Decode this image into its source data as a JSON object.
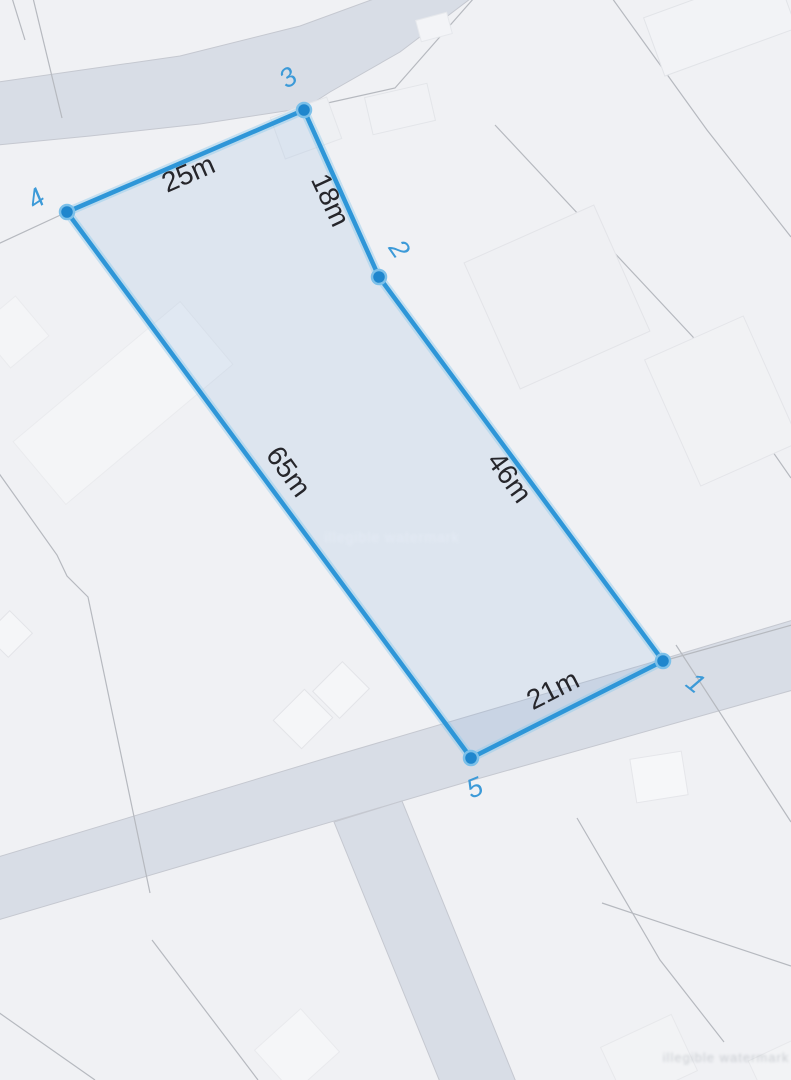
{
  "map": {
    "view": "parcel-measurement-overlay",
    "colors": {
      "background": "#f0f1f4",
      "road": "#d8dde6",
      "parcel_line": "#b6b9bf",
      "polygon_stroke": "#2e96d8",
      "polygon_fill_tint": "#7aa8da",
      "vertex_dot": "#1f86cd",
      "vertex_label_blue": "#3c9ad8",
      "measurement_text": "#26262b"
    },
    "polygon": {
      "vertices": [
        {
          "label": "1",
          "x": 663,
          "y": 661
        },
        {
          "label": "2",
          "x": 379,
          "y": 277
        },
        {
          "label": "3",
          "x": 304,
          "y": 110
        },
        {
          "label": "4",
          "x": 67,
          "y": 212
        },
        {
          "label": "5",
          "x": 471,
          "y": 758
        }
      ],
      "edges": [
        {
          "from": "4",
          "to": "3",
          "length": "25m"
        },
        {
          "from": "3",
          "to": "2",
          "length": "18m"
        },
        {
          "from": "2",
          "to": "1",
          "length": "46m"
        },
        {
          "from": "1",
          "to": "5",
          "length": "21m"
        },
        {
          "from": "5",
          "to": "4",
          "length": "65m"
        }
      ]
    },
    "watermarks": {
      "center": "illegible watermark",
      "bottom_right": "illegible watermark"
    }
  }
}
